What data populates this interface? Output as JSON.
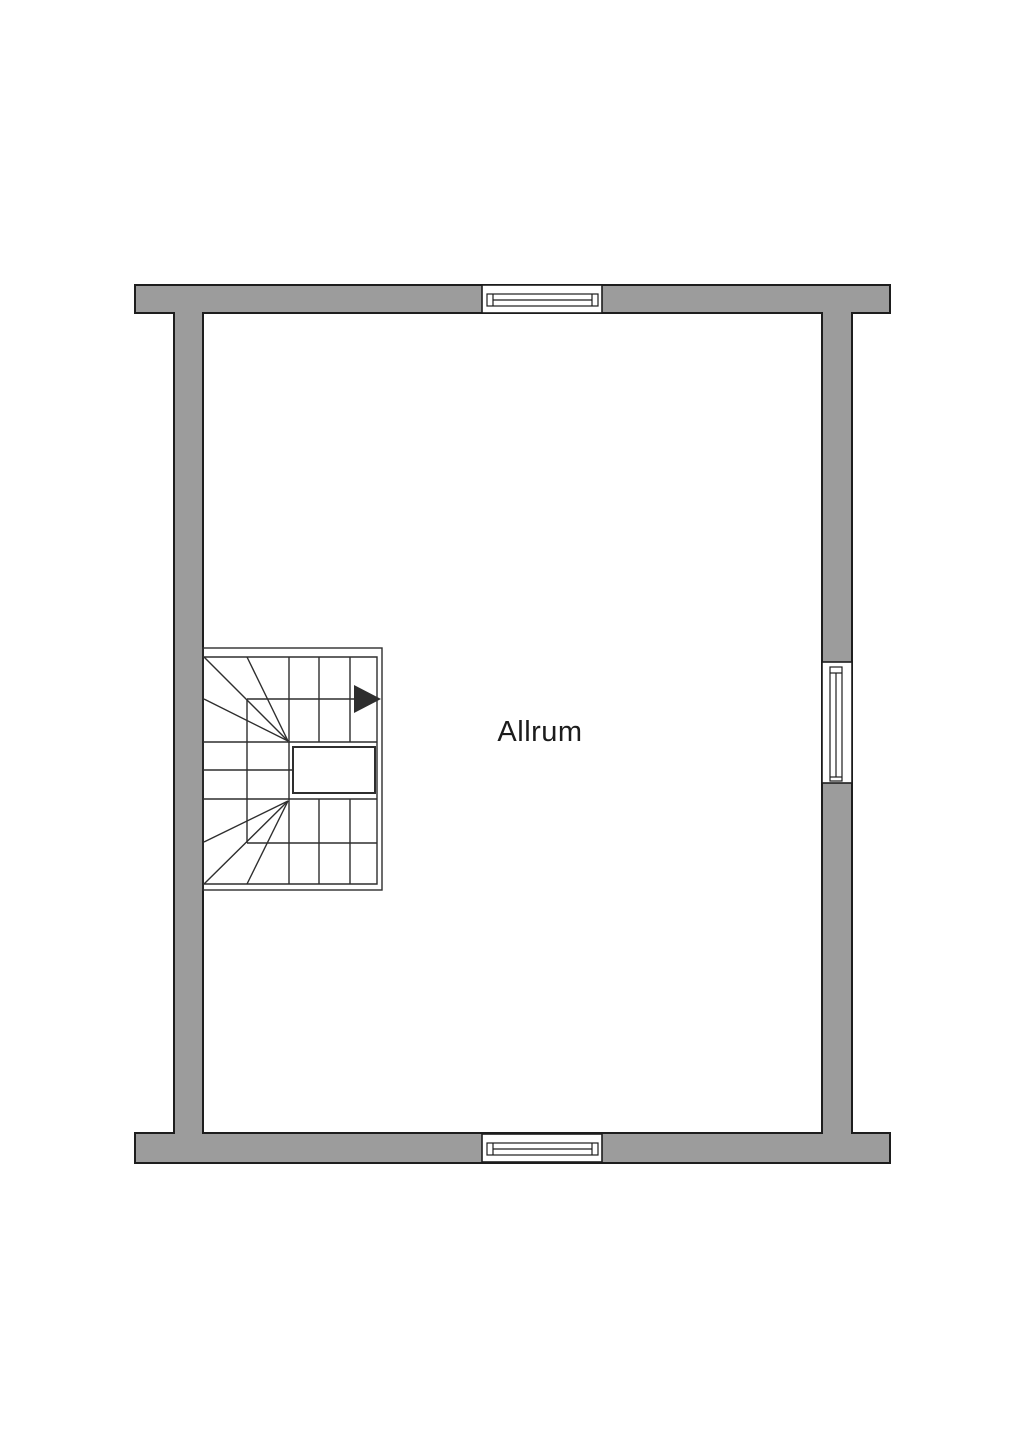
{
  "page": {
    "background": "#ffffff"
  },
  "colors": {
    "wall_fill": "#9c9c9c",
    "outline": "#1d1d1d",
    "stair_line": "#2e2e2e",
    "window_fill": "#ffffff",
    "text": "#1c1c1c"
  },
  "room": {
    "label": "Allrum"
  },
  "icons": {
    "stair_direction_arrow": "filled-right-triangle"
  },
  "plan": {
    "type": "floor-plan",
    "walls": "exterior-walls-with-flared-top-and-bottom-bands",
    "windows": [
      "top-wall-window",
      "right-wall-window",
      "bottom-wall-window"
    ],
    "staircase": "winder-staircase-with-central-landing"
  }
}
